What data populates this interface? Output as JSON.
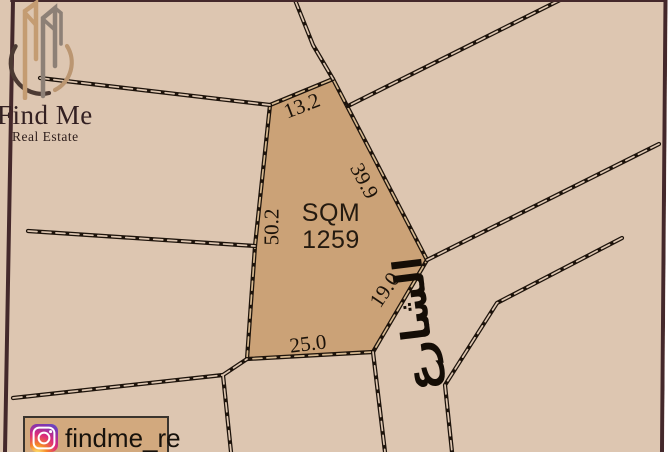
{
  "brand": {
    "name": "Find Me",
    "tagline": "Real Estate",
    "logo_icon": "buildings-in-circle"
  },
  "social": {
    "icon": "instagram-icon",
    "handle": "findme_re"
  },
  "plot": {
    "area_unit": "SQM",
    "area_value": "1259",
    "dimensions": {
      "top": "13.2",
      "upper_right": "39.9",
      "left": "50.2",
      "lower_right": "19.0",
      "bottom": "25.0"
    }
  },
  "street": {
    "name": "الشارع"
  },
  "colors": {
    "background": "#ddc6b1",
    "plot_fill": "#cba277",
    "line": "#1d130b",
    "frame": "#44282b",
    "badge_fill": "#d2a97e"
  }
}
